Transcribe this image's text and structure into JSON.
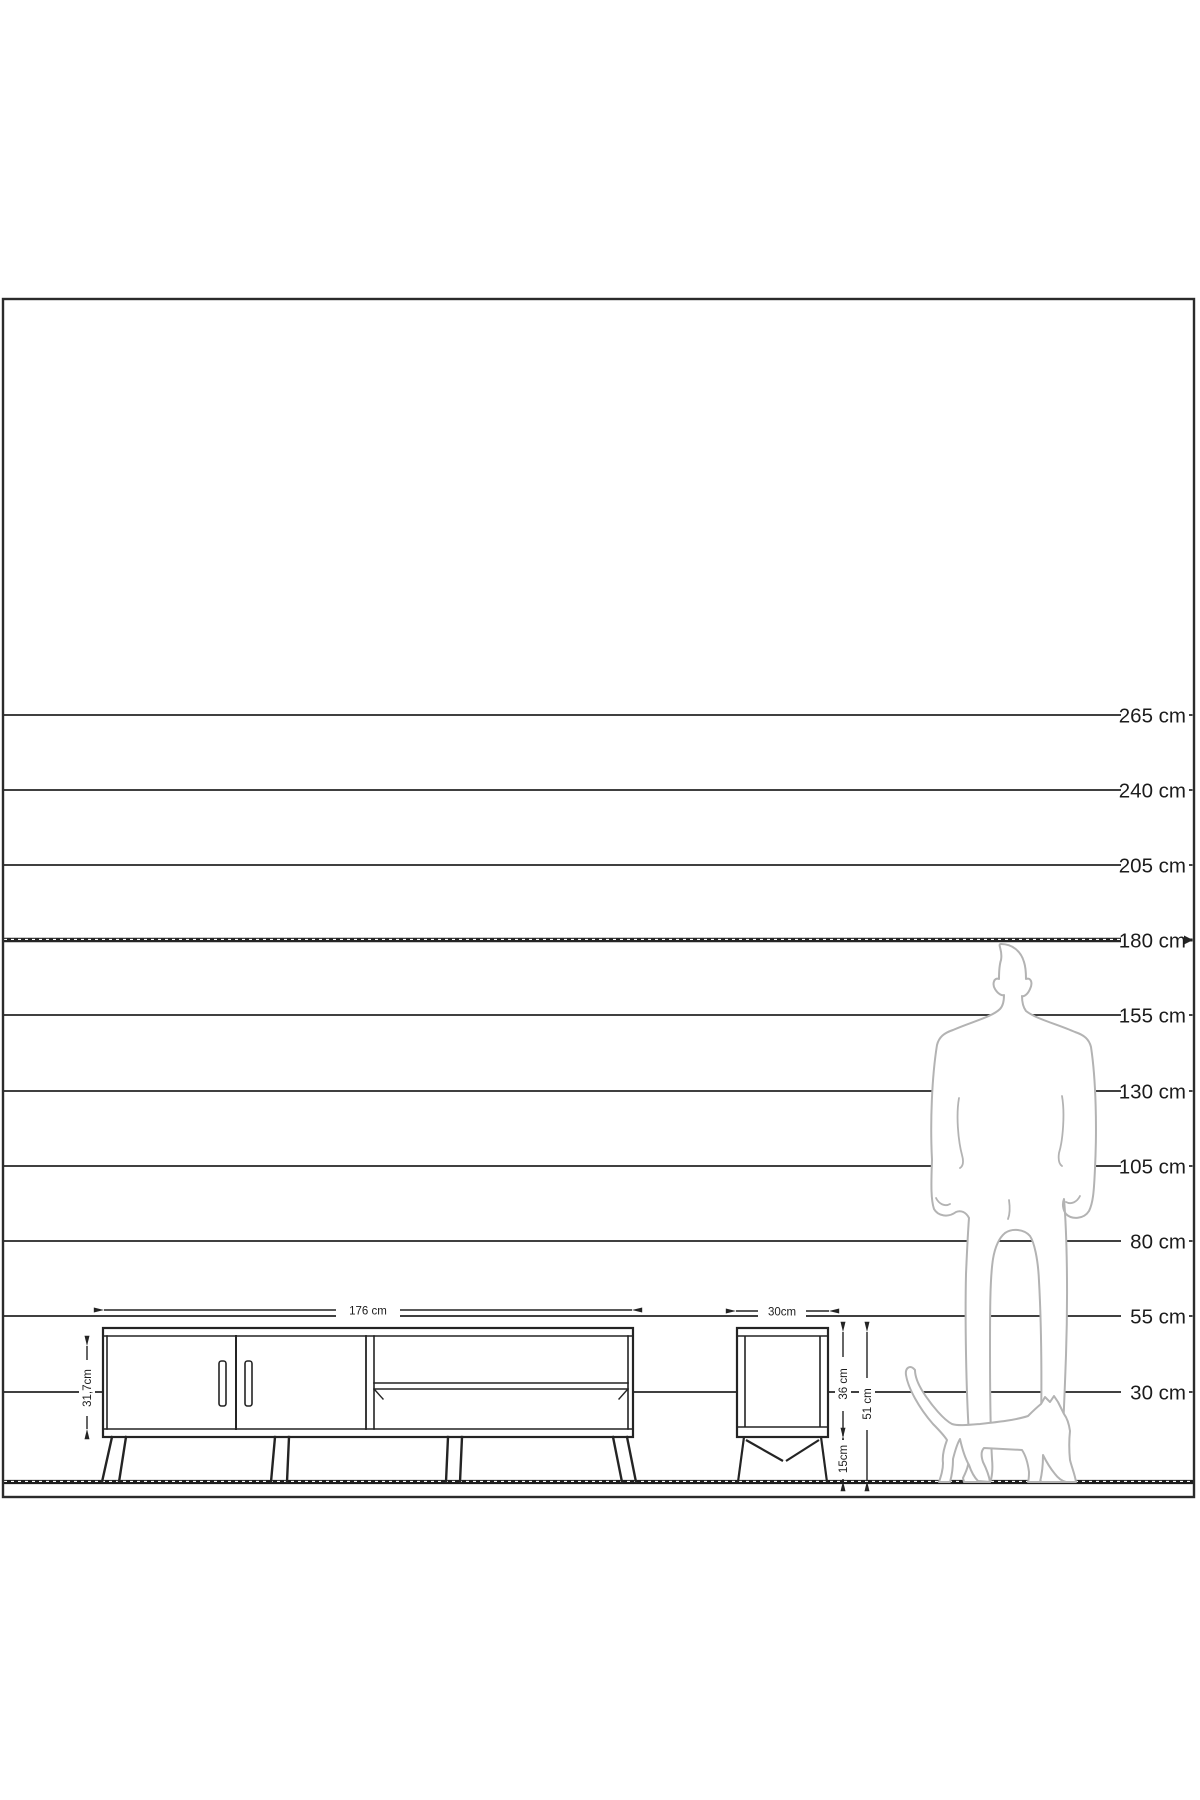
{
  "page": {
    "background": "#ffffff"
  },
  "diagram": {
    "unit": "cm",
    "line_color": "#242424",
    "silhouette_color": "#b3b3b3",
    "scale_lines": [
      {
        "label": "265 cm",
        "value": 265,
        "emphasis": false
      },
      {
        "label": "240 cm",
        "value": 240,
        "emphasis": false
      },
      {
        "label": "205 cm",
        "value": 205,
        "emphasis": false
      },
      {
        "label": "180 cm",
        "value": 180,
        "emphasis": true
      },
      {
        "label": "155 cm",
        "value": 155,
        "emphasis": false
      },
      {
        "label": "130 cm",
        "value": 130,
        "emphasis": false
      },
      {
        "label": "105 cm",
        "value": 105,
        "emphasis": false
      },
      {
        "label": "80 cm",
        "value": 80,
        "emphasis": false
      },
      {
        "label": "55 cm",
        "value": 55,
        "emphasis": false
      },
      {
        "label": "30 cm",
        "value": 30,
        "emphasis": false
      }
    ],
    "tv_stand": {
      "width_label": "176 cm",
      "height_label": "31,7cm"
    },
    "side_table": {
      "width_label": "30cm",
      "body_height_label": "36 cm",
      "leg_height_label": "15cm",
      "total_height_label": "51 cm"
    }
  }
}
